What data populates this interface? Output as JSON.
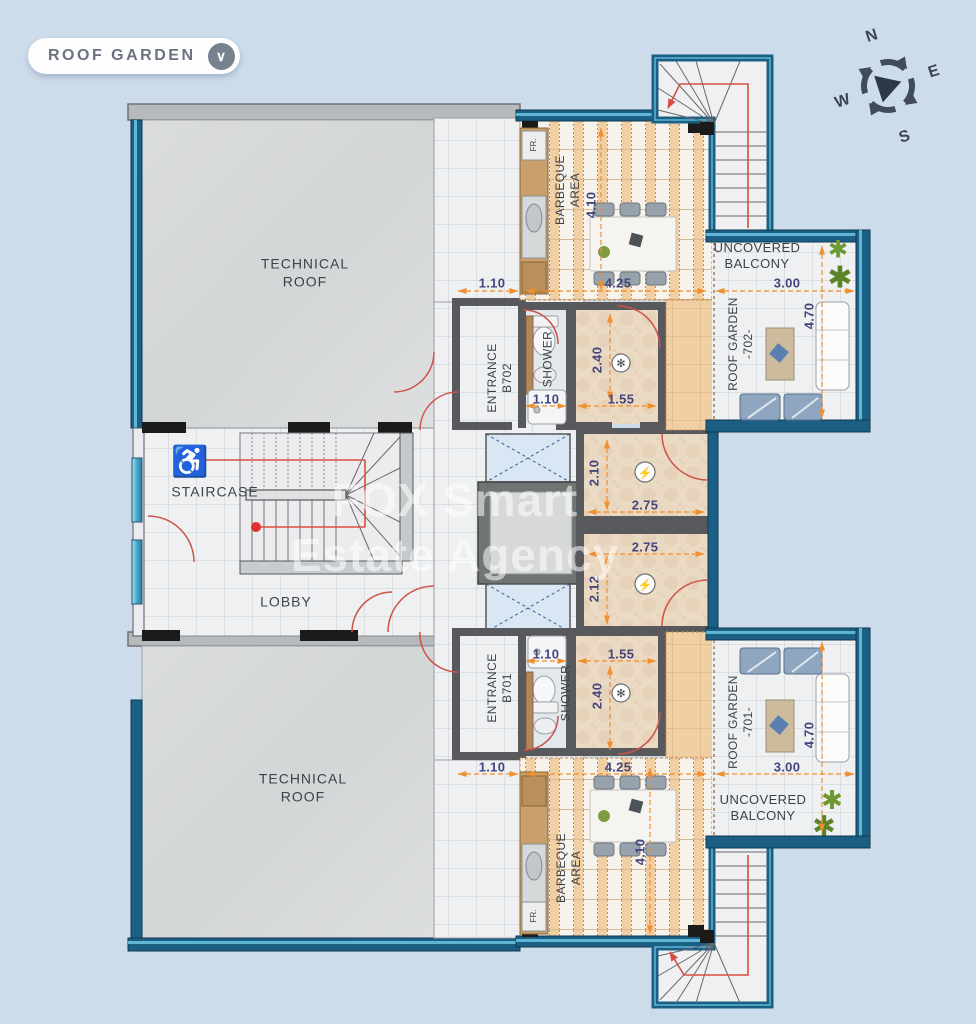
{
  "header": {
    "floor_label": "ROOF GARDEN",
    "dropdown_glyph": "∨"
  },
  "compass": {
    "north": "N",
    "east": "E",
    "south": "S",
    "west": "W"
  },
  "watermark": "FOX Smart\nEstate Agency",
  "rooms": {
    "technical_roof_top": "TECHNICAL\nROOF",
    "technical_roof_bottom": "TECHNICAL\nROOF",
    "staircase": "STAIRCASE",
    "lobby": "LOBBY",
    "entrance_702": "ENTRANCE\nB702",
    "entrance_701": "ENTRANCE\nB701",
    "shower_702": "SHOWER",
    "shower_701": "SHOWER",
    "barbeque_702": "BARBEQUE\nAREA",
    "barbeque_701": "BARBEQUE\nAREA",
    "roof_garden_702": "ROOF GARDEN\n-702-",
    "roof_garden_701": "ROOF GARDEN\n-701-",
    "balcony_702": "UNCOVERED\nBALCONY",
    "balcony_701": "UNCOVERED\nBALCONY",
    "fridge_702": "FR.",
    "fridge_701": "FR."
  },
  "dimensions": {
    "u702": {
      "entrance_width": "1.10",
      "deck_width": "4.25",
      "balcony_width": "3.00",
      "deck_length": "4.10",
      "garden_length": "4.70",
      "shower_width": "1.10",
      "hall_width": "1.55",
      "hall_depth": "2.40",
      "room_depth": "2.10",
      "room_width": "2.75"
    },
    "u701": {
      "entrance_width": "1.10",
      "deck_width": "4.25",
      "balcony_width": "3.00",
      "deck_length": "4.10",
      "garden_length": "4.70",
      "shower_width": "1.10",
      "hall_width": "1.55",
      "hall_depth": "2.40",
      "room_depth": "2.12",
      "room_width": "2.75"
    }
  },
  "icons": {
    "electric": "⚡",
    "fixture": "✻",
    "plant": "✱",
    "wheelchair": "♿"
  },
  "colors": {
    "wall_teal": "#1c5f84",
    "deck_orange": "#f2d0a4",
    "dim_text": "#45457e",
    "dim_arrow": "#ef8f2e",
    "door_red": "#d5574a",
    "glass_cyan": "#6fc8e6"
  }
}
